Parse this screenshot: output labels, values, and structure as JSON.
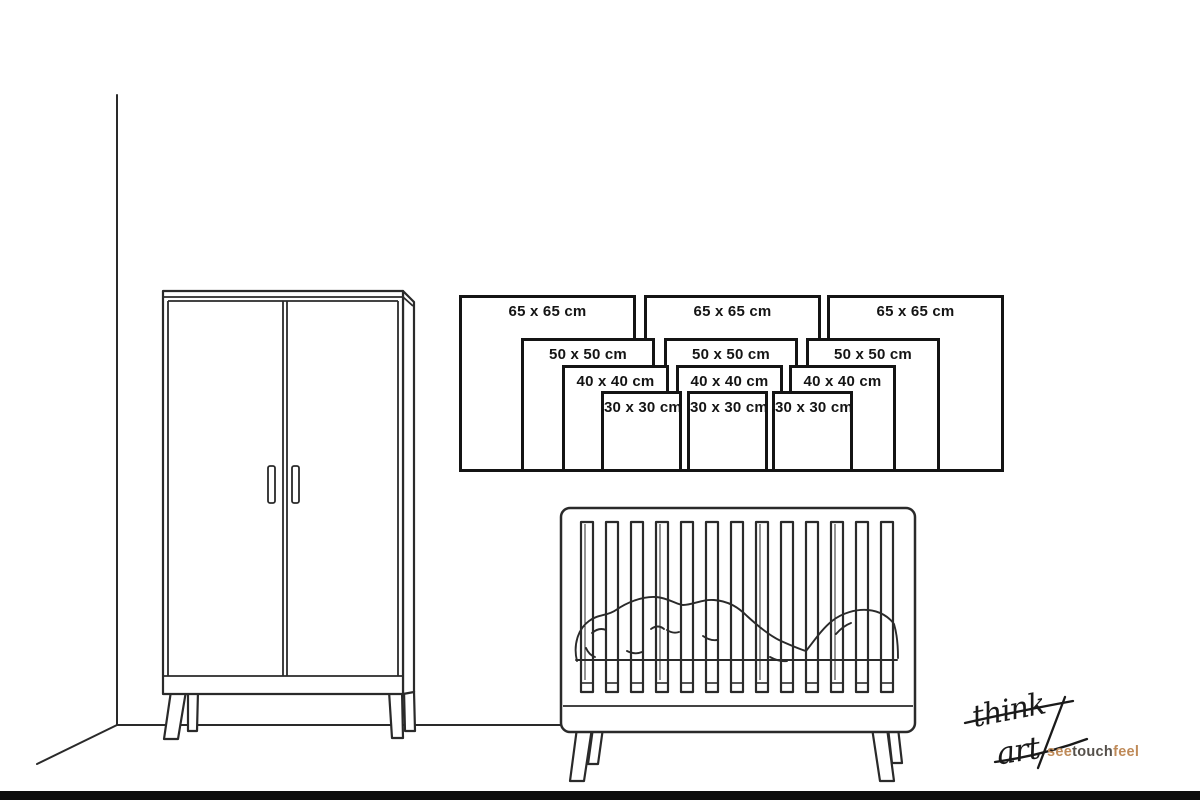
{
  "canvas": {
    "width": 1200,
    "height": 800,
    "background": "#ffffff",
    "bottom_bar_color": "#0d0d0d",
    "line_art_color": "#2a2a2a"
  },
  "scene": {
    "illustrations": [
      "wall-corner",
      "wardrobe",
      "baby-crib"
    ]
  },
  "size_chart": {
    "unit": "cm",
    "sizes": [
      "65 x 65 cm",
      "50 x 50 cm",
      "40 x 40 cm",
      "30 x 30 cm"
    ],
    "squares": [
      {
        "id": "left-65",
        "label": "65 x 65 cm",
        "x": 459,
        "y": 295,
        "size": 177
      },
      {
        "id": "middle-65",
        "label": "65 x 65 cm",
        "x": 644,
        "y": 295,
        "size": 177
      },
      {
        "id": "right-65",
        "label": "65 x 65 cm",
        "x": 827,
        "y": 295,
        "size": 177
      },
      {
        "id": "left-50",
        "label": "50 x 50 cm",
        "x": 521,
        "y": 338,
        "size": 134
      },
      {
        "id": "middle-50",
        "label": "50 x 50 cm",
        "x": 664,
        "y": 338,
        "size": 134
      },
      {
        "id": "right-50",
        "label": "50 x 50 cm",
        "x": 806,
        "y": 338,
        "size": 134
      },
      {
        "id": "left-40",
        "label": "40 x 40 cm",
        "x": 562,
        "y": 365,
        "size": 107
      },
      {
        "id": "middle-40",
        "label": "40 x 40 cm",
        "x": 676,
        "y": 365,
        "size": 107
      },
      {
        "id": "right-40",
        "label": "40 x 40 cm",
        "x": 789,
        "y": 365,
        "size": 107
      },
      {
        "id": "left-30",
        "label": "30 x 30 cm",
        "x": 601,
        "y": 391,
        "size": 81
      },
      {
        "id": "middle-30",
        "label": "30 x 30 cm",
        "x": 687,
        "y": 391,
        "size": 81
      },
      {
        "id": "right-30",
        "label": "30 x 30 cm",
        "x": 772,
        "y": 391,
        "size": 81
      }
    ]
  },
  "logo": {
    "script_line1": "think",
    "script_line2": "art",
    "tagline": {
      "part1": "see",
      "part2": "touch",
      "part3": "feel",
      "color_accent": "#bf8a58",
      "color_mid": "#55504a"
    },
    "ink_color": "#1a1a1a"
  }
}
